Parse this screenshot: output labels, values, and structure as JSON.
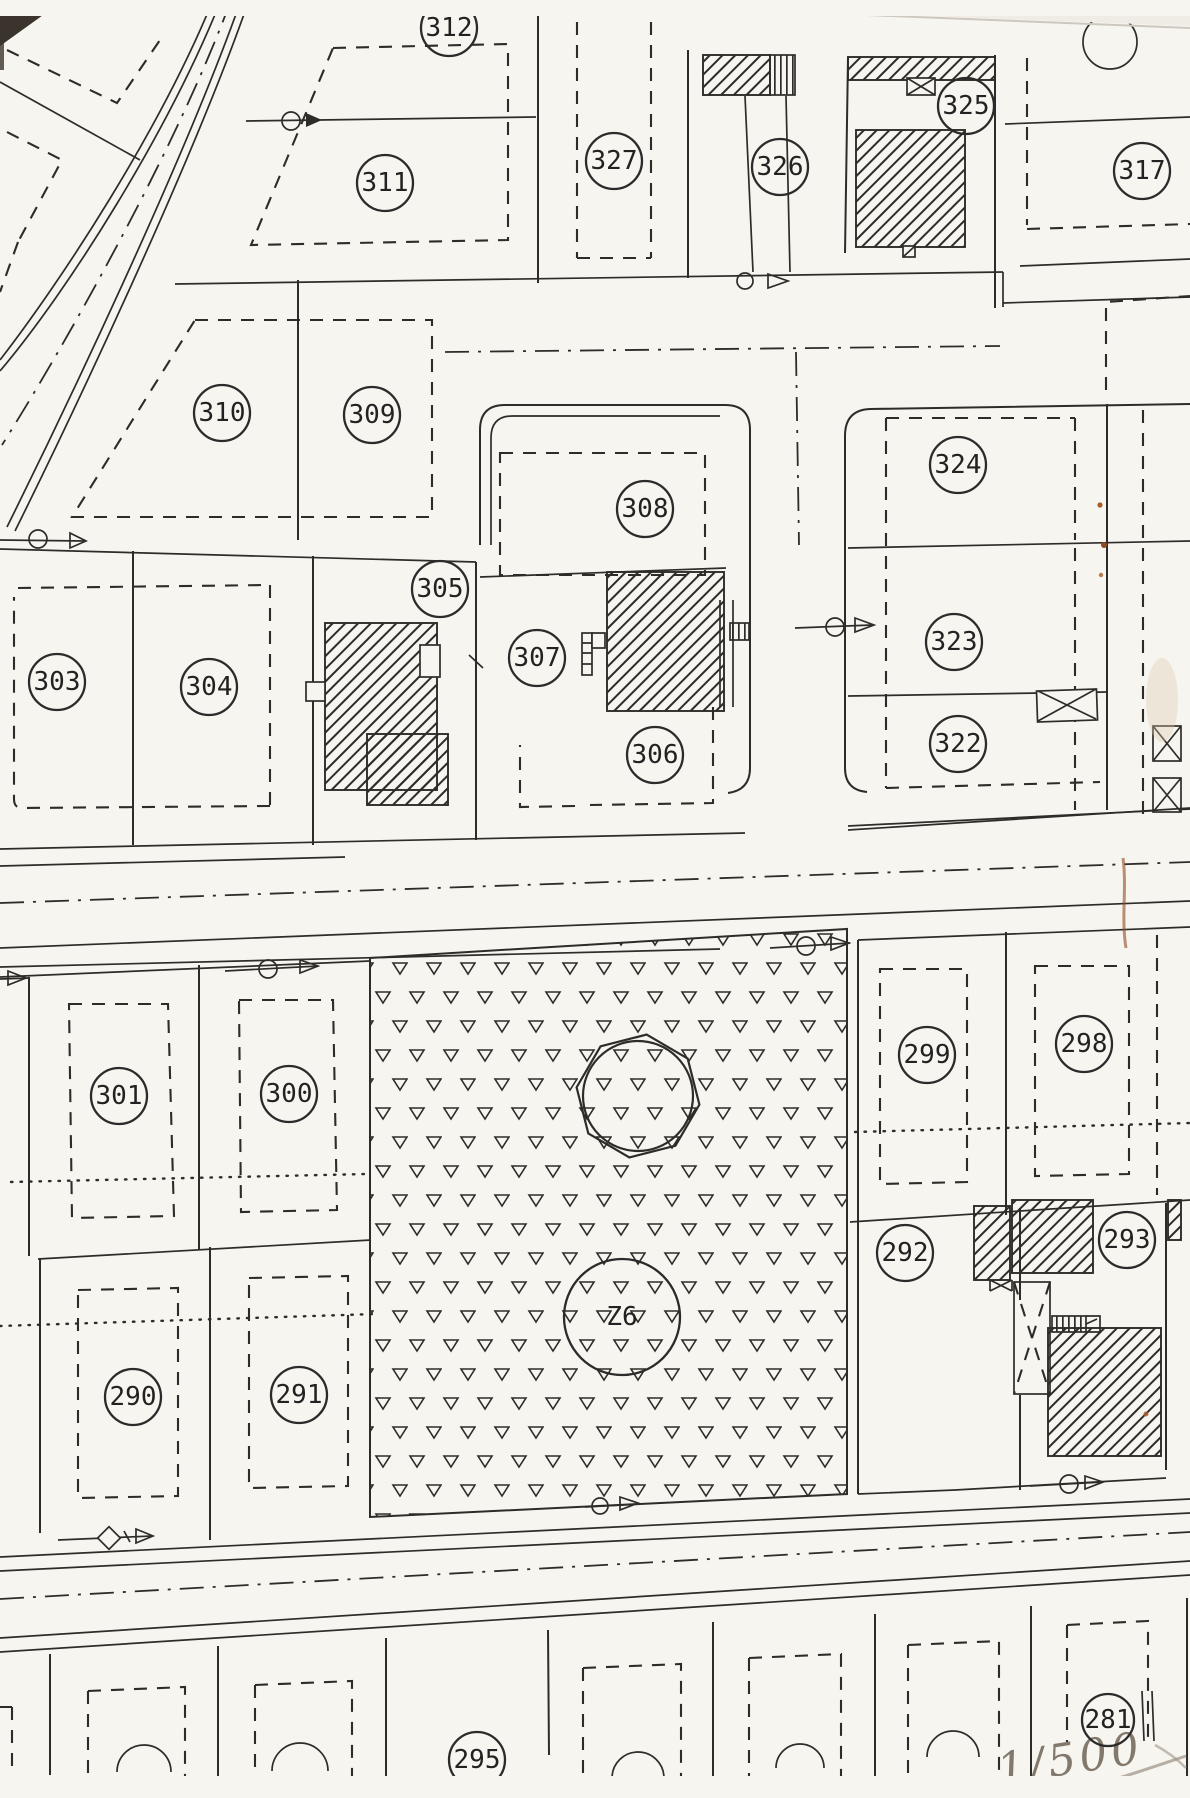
{
  "document": {
    "type": "cadastral plan scan",
    "scale_note": "1/500",
    "area_label": "Z6"
  },
  "parcels": [
    {
      "label": "312",
      "x": 449,
      "y": 28
    },
    {
      "label": "311",
      "x": 385,
      "y": 183
    },
    {
      "label": "327",
      "x": 614,
      "y": 161
    },
    {
      "label": "326",
      "x": 780,
      "y": 167
    },
    {
      "label": "325",
      "x": 966,
      "y": 106
    },
    {
      "label": "317",
      "x": 1142,
      "y": 171
    },
    {
      "label": "310",
      "x": 222,
      "y": 413
    },
    {
      "label": "309",
      "x": 372,
      "y": 415
    },
    {
      "label": "308",
      "x": 645,
      "y": 509
    },
    {
      "label": "324",
      "x": 958,
      "y": 465
    },
    {
      "label": "305",
      "x": 440,
      "y": 589
    },
    {
      "label": "307",
      "x": 537,
      "y": 658
    },
    {
      "label": "303",
      "x": 57,
      "y": 682
    },
    {
      "label": "304",
      "x": 209,
      "y": 687
    },
    {
      "label": "323",
      "x": 954,
      "y": 642
    },
    {
      "label": "322",
      "x": 958,
      "y": 744
    },
    {
      "label": "306",
      "x": 655,
      "y": 755
    },
    {
      "label": "301",
      "x": 119,
      "y": 1096
    },
    {
      "label": "300",
      "x": 289,
      "y": 1094
    },
    {
      "label": "299",
      "x": 927,
      "y": 1055
    },
    {
      "label": "298",
      "x": 1084,
      "y": 1044
    },
    {
      "label": "292",
      "x": 905,
      "y": 1253
    },
    {
      "label": "293",
      "x": 1127,
      "y": 1240
    },
    {
      "label": "290",
      "x": 133,
      "y": 1397
    },
    {
      "label": "291",
      "x": 299,
      "y": 1395
    },
    {
      "label": "Z6",
      "x": 622,
      "y": 1317,
      "r": 58,
      "fs": 52
    },
    {
      "label": "295",
      "x": 477,
      "y": 1760
    },
    {
      "label": "281",
      "x": 1108,
      "y": 1720,
      "r": 26,
      "fs": 23
    }
  ],
  "symbols": [
    {
      "name": "survey-point-arrow",
      "x": 291,
      "y": 121
    },
    {
      "name": "survey-point-arrow",
      "x": 743,
      "y": 281
    },
    {
      "name": "survey-point-arrow",
      "x": 38,
      "y": 539
    },
    {
      "name": "survey-point-arrow",
      "x": 835,
      "y": 627
    },
    {
      "name": "survey-point-arrow",
      "x": 268,
      "y": 969
    },
    {
      "name": "survey-point-arrow",
      "x": 806,
      "y": 946
    },
    {
      "name": "survey-diamond-arrow",
      "x": 109,
      "y": 1538
    },
    {
      "name": "survey-point-arrow",
      "x": 600,
      "y": 1506
    },
    {
      "name": "survey-point-arrow",
      "x": 1069,
      "y": 1484
    },
    {
      "name": "octagon-reservoir-mark",
      "x": 638,
      "y": 1096
    }
  ],
  "colors": {
    "ink": "#2e2c29",
    "paper": "#f7f5f0",
    "rust_stain": "#a85c28",
    "pencil": "#82796c"
  }
}
